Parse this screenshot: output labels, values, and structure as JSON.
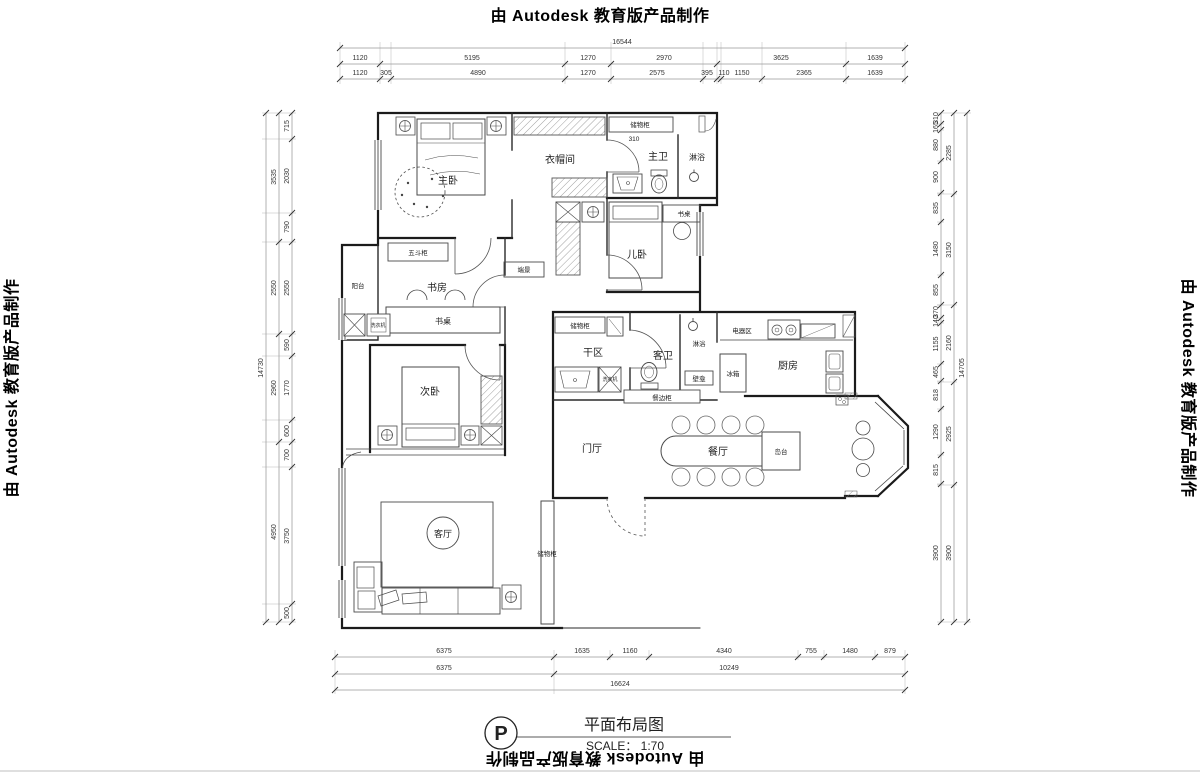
{
  "watermark": {
    "text": "由 Autodesk 教育版产品制作"
  },
  "title_block": {
    "marker": "P",
    "title": "平面布局图",
    "scale_label": "SCALE： 1:70"
  },
  "labels": {
    "master_bedroom": "主卧",
    "cloakroom": "衣帽间",
    "storage_cabinet_top": "储物柜",
    "storage_cabinet_dim": "310",
    "master_bath": "主卫",
    "master_shower": "淋浴",
    "kids_room": "儿卧",
    "kids_desk": "书桌",
    "study": "书房",
    "study_desk": "书桌",
    "drawer_chest": "五斗柜",
    "feature_wall": "端景",
    "balcony": "阳台",
    "washer": "洗衣机",
    "second_bedroom": "次卧",
    "dry_area": "干区",
    "storage_cabinet_mid": "储物柜",
    "guest_bath": "客卫",
    "guest_shower": "淋浴",
    "niche": "壁龛",
    "sideboard": "餐边柜",
    "appliance_area": "电器区",
    "fridge": "冰箱",
    "kitchen": "厨房",
    "entry_hall": "门厅",
    "dining_room": "餐厅",
    "island": "岛台",
    "living_room": "客厅",
    "storage_cabinet_living": "储物柜"
  },
  "dims": {
    "top": {
      "total": "16544",
      "row1": [
        "1120",
        "5195",
        "1270",
        "2970",
        "3625",
        "1639"
      ],
      "row2": [
        "1120",
        "305",
        "4890",
        "1270",
        "2575",
        "395",
        "110",
        "1150",
        "2365",
        "1639"
      ]
    },
    "bottom": {
      "row1": [
        "6375",
        "1635",
        "1160",
        "4340",
        "755",
        "1480",
        "879"
      ],
      "row2": [
        "6375",
        "10249"
      ],
      "total": "16624"
    },
    "left": {
      "total": "14730",
      "col1": [
        "3535",
        "2550",
        "2960",
        "4950"
      ],
      "col2": [
        "715",
        "2030",
        "790",
        "2550",
        "590",
        "1770",
        "600",
        "700",
        "3750",
        "500"
      ]
    },
    "right": {
      "total": "14705",
      "col1": [
        "2285",
        "3150",
        "2160",
        "2925",
        "3900"
      ],
      "col2": [
        "310",
        "165",
        "880",
        "900",
        "835",
        "1480",
        "855",
        "370",
        "140",
        "1155",
        "465",
        "818",
        "1290",
        "815",
        "3900"
      ]
    }
  }
}
